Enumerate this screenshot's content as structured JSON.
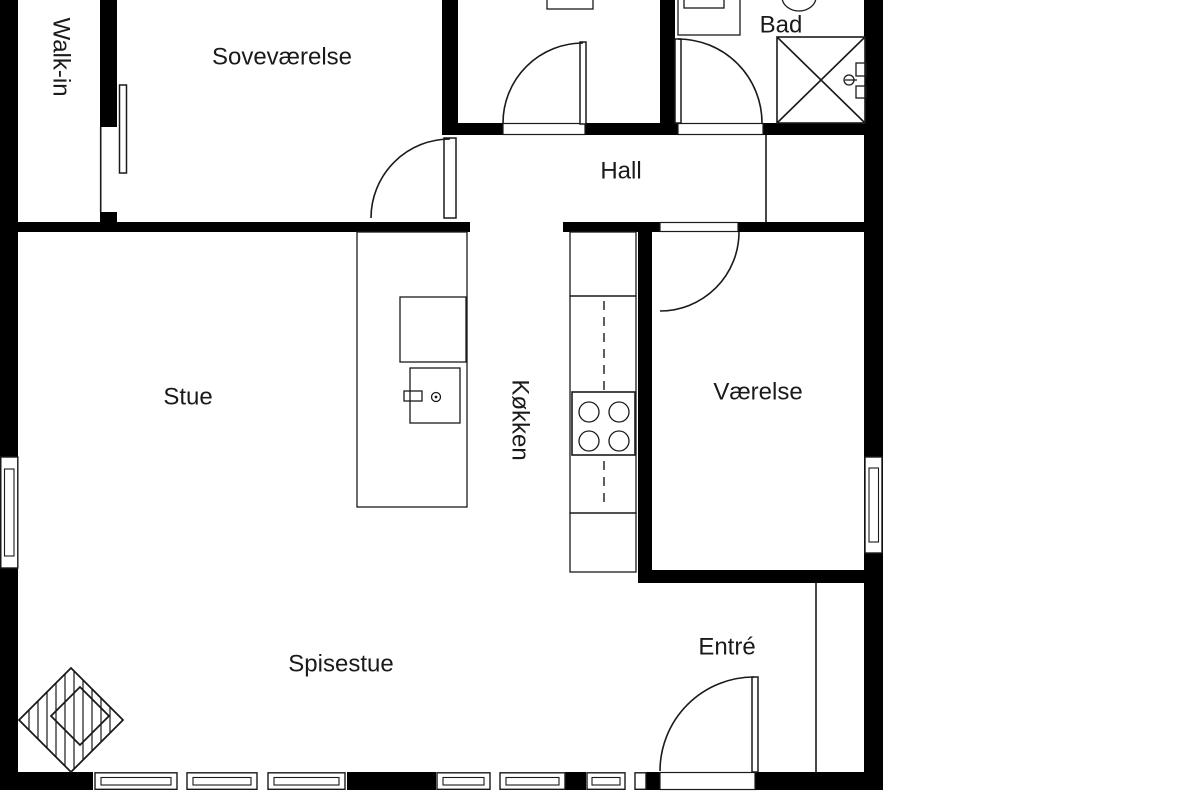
{
  "colors": {
    "background": "#ffffff",
    "walls": "#000000",
    "lines": "#1a1a1a",
    "text": "#1a1a1a"
  },
  "rooms": [
    {
      "id": "walk_in",
      "label": "Walk-in",
      "orientation": "vertical"
    },
    {
      "id": "sovevaerelse",
      "label": "Soveværelse",
      "orientation": "horizontal"
    },
    {
      "id": "bad",
      "label": "Bad",
      "orientation": "horizontal"
    },
    {
      "id": "hall",
      "label": "Hall",
      "orientation": "horizontal"
    },
    {
      "id": "stue",
      "label": "Stue",
      "orientation": "horizontal"
    },
    {
      "id": "koekken",
      "label": "Køkken",
      "orientation": "vertical"
    },
    {
      "id": "vaerelse",
      "label": "Værelse",
      "orientation": "horizontal"
    },
    {
      "id": "spisestue",
      "label": "Spisestue",
      "orientation": "horizontal"
    },
    {
      "id": "entre",
      "label": "Entré",
      "orientation": "horizontal"
    }
  ],
  "fixtures": [
    "shower",
    "shower-faucet",
    "bathroom-sink",
    "toilet",
    "washer",
    "kitchen-island",
    "kitchen-island-sink",
    "kitchen-counter",
    "stove",
    "fireplace",
    "sliding-door",
    "entrance-door"
  ]
}
